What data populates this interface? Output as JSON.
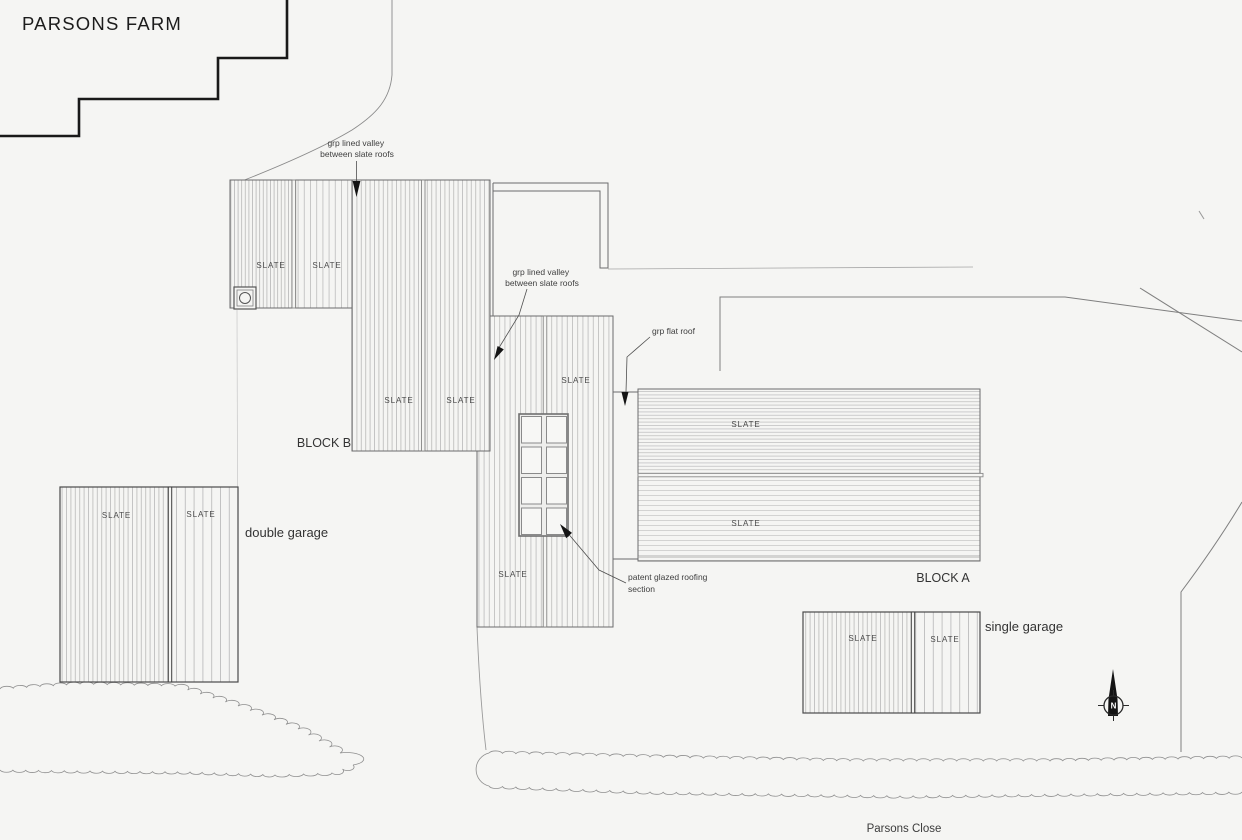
{
  "title": "PARSONS FARM",
  "street": {
    "name": "Parsons Close"
  },
  "compass": {
    "north_label": "N"
  },
  "palette": {
    "background": "#f5f5f3",
    "ink": "#3c3c3c",
    "roof_outline": "#6c6c6c",
    "site_boundary": "#191919",
    "hatch": "#b0b0b0"
  },
  "buildings": {
    "block_b": {
      "label": "BLOCK B",
      "slates": [
        "SLATE",
        "SLATE",
        "SLATE",
        "SLATE",
        "SLATE",
        "SLATE"
      ]
    },
    "block_a": {
      "label": "BLOCK A",
      "slates": [
        "SLATE",
        "SLATE"
      ]
    },
    "double_garage": {
      "label": "double garage",
      "slates": [
        "SLATE",
        "SLATE"
      ]
    },
    "single_garage": {
      "label": "single garage",
      "slates": [
        "SLATE",
        "SLATE"
      ]
    }
  },
  "annotations": {
    "valley_top": {
      "line1": "grp lined valley",
      "line2": "between slate roofs"
    },
    "valley_mid": {
      "line1": "grp lined valley",
      "line2": "between slate roofs"
    },
    "flat_roof": {
      "line1": "grp flat roof"
    },
    "patent_glazing": {
      "line1": "patent glazed roofing",
      "line2": "section"
    }
  }
}
